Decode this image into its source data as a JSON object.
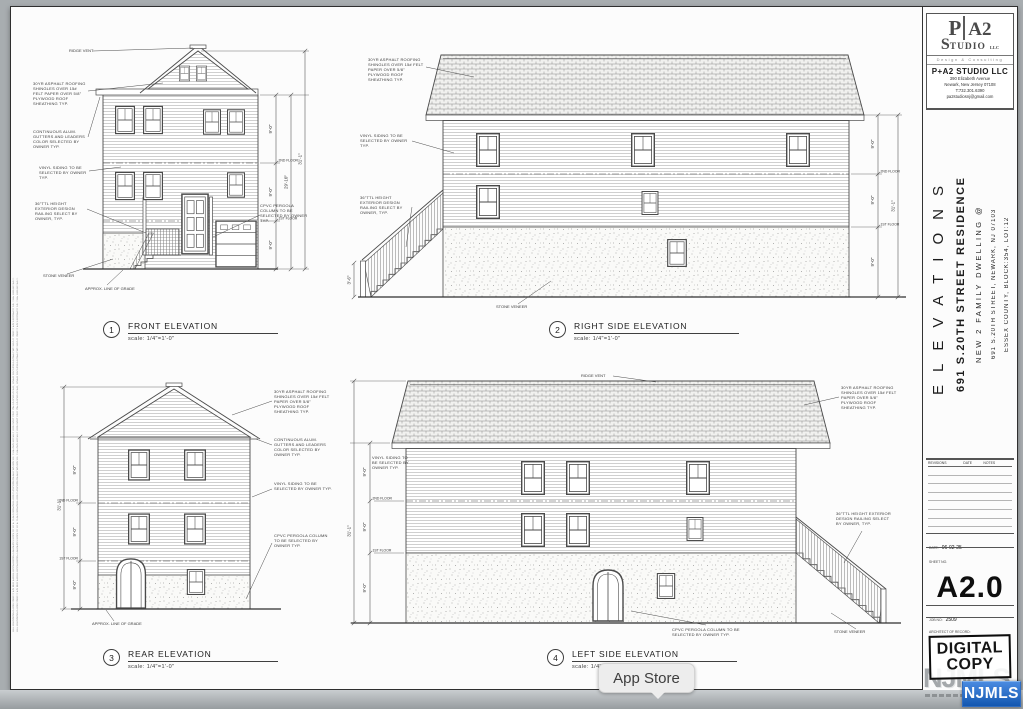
{
  "sheet": {
    "edge_text": "ALL DRAWINGS AND WRITTEN MATERIAL APPEARING HEREIN CONSTITUTE THE ORIGINAL AND UNPUBLISHED WORK OF THE ARCHITECT AND MAY NOT BE DUPLICATED, USED OR DISCLOSED WITHOUT WRITTEN CONSENT OF THE ARCHITECT."
  },
  "titleblock": {
    "logo_p": "P",
    "logo_a2": "A2",
    "logo_s": "S",
    "logo_tudio": "TUDIO",
    "logo_llc": "LLC",
    "tagline": "Design & Consulting",
    "firm": "P+A2 STUDIO LLC",
    "address1": "390 Elizabeth Avenue",
    "address2": "Newark, New Jersey 07108",
    "phone": "T:732.301.6390",
    "email": "pa2studiosnj@gmail.com",
    "sheet_title": "ELEVATIONS",
    "project_title": "691 S.20TH STREET RESIDENCE",
    "project_line2": "NEW 2 FAMILY DWELLING @",
    "project_line3": "691 S.20TH STREET, NEWARK, NJ 07103",
    "project_line4": "ESSEX COUNTY, BLOCK:354, LOT:12",
    "rev_col1": "REVISIONS",
    "rev_col2": "DATE",
    "rev_col3": "NOTES",
    "date_label": "DATE:",
    "date_value": "06-02-25",
    "sheet_no_label": "SHEET NO.",
    "sheet_no": "A2.0",
    "job_label": "JOB NO:",
    "job_value": "2509",
    "architect_label": "ARCHITECT OF RECORD:",
    "stamp_line1": "DIGITAL",
    "stamp_line2": "COPY",
    "watermark": "NJMLS",
    "badge": "NJMLS",
    "badge_color": "#1b62c4"
  },
  "plates": {
    "front": {
      "num": "1",
      "title": "FRONT ELEVATION",
      "scale": "scale: 1/4\"=1'-0\""
    },
    "right": {
      "num": "2",
      "title": "RIGHT SIDE ELEVATION",
      "scale": "scale: 1/4\"=1'-0\""
    },
    "rear": {
      "num": "3",
      "title": "REAR ELEVATION",
      "scale": "scale: 1/4\"=1'-0\""
    },
    "left": {
      "num": "4",
      "title": "LEFT SIDE ELEVATION",
      "scale": "scale: 1/4\"=1'-0\""
    }
  },
  "notes": {
    "ridge_vent": "RIDGE VENT",
    "roofing": "30YR ASPHALT ROOFING SHINGLES OVER 15# FELT PAPER OVER 5/8\" PLYWOOD ROOF SHEATHING TYP.",
    "gutters": "CONTINUOUS ALUM. GUTTERS AND LEADERS COLOR SELECTED BY OWNER TYP.",
    "siding": "VINYL SIDING TO BE SELECTED BY OWNER TYP.",
    "railing": "36\"TTL HEIGHT EXTERIOR DESIGN RAILING SELECT BY OWNER, TYP.",
    "stone": "STONE VENEER",
    "cpvc": "CPVC PERGOLA COLUMN TO BE SELECTED BY OWNER TYP.",
    "grade": "APPROX. LINE OF GRADE"
  },
  "dims": {
    "story": "9'-0\"",
    "total": "31'-1\"",
    "subtotal": "29'-10\"",
    "stair": "3'-6\"",
    "floor2": "2ND FLOOR",
    "floor1": "1ST FLOOR"
  },
  "tooltip": {
    "label": "App Store"
  }
}
